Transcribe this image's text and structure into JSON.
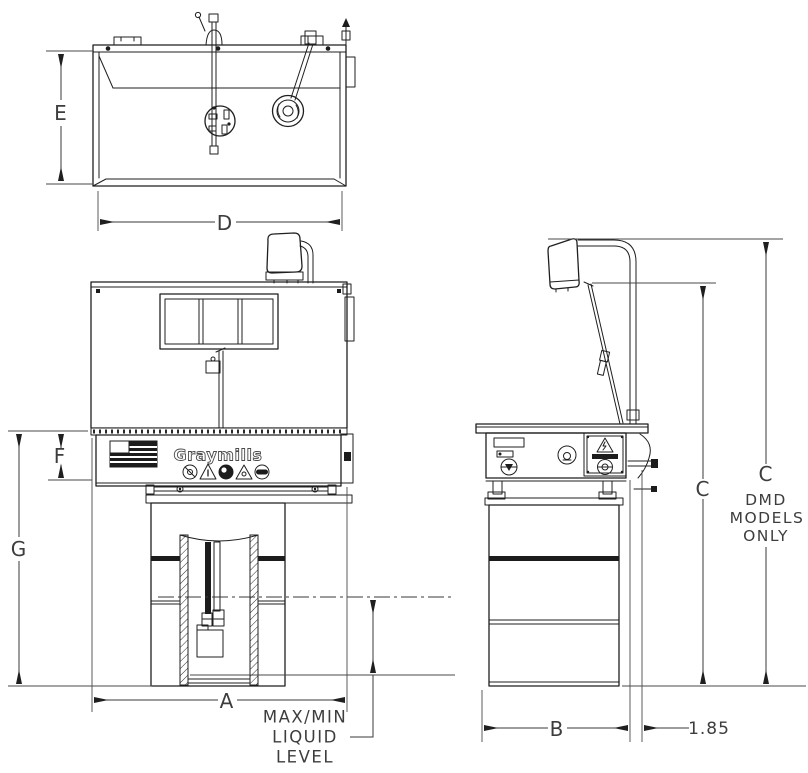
{
  "drawing": {
    "type": "parts-washer-dimensional-drawing",
    "brand": "Graymills",
    "dims": {
      "A": "A",
      "B": "B",
      "C": "C",
      "D": "D",
      "E": "E",
      "F": "F",
      "G": "G",
      "offset": "1.85"
    },
    "notes": {
      "dmd_dim": "C",
      "dmd": [
        "DMD",
        "MODELS",
        "ONLY"
      ],
      "liquid": [
        "MAX/MIN",
        "LIQUID",
        "LEVEL"
      ]
    },
    "colors": {
      "line": "#1f1f1f",
      "dimension": "#3d3d3d",
      "background": "#ffffff"
    }
  }
}
